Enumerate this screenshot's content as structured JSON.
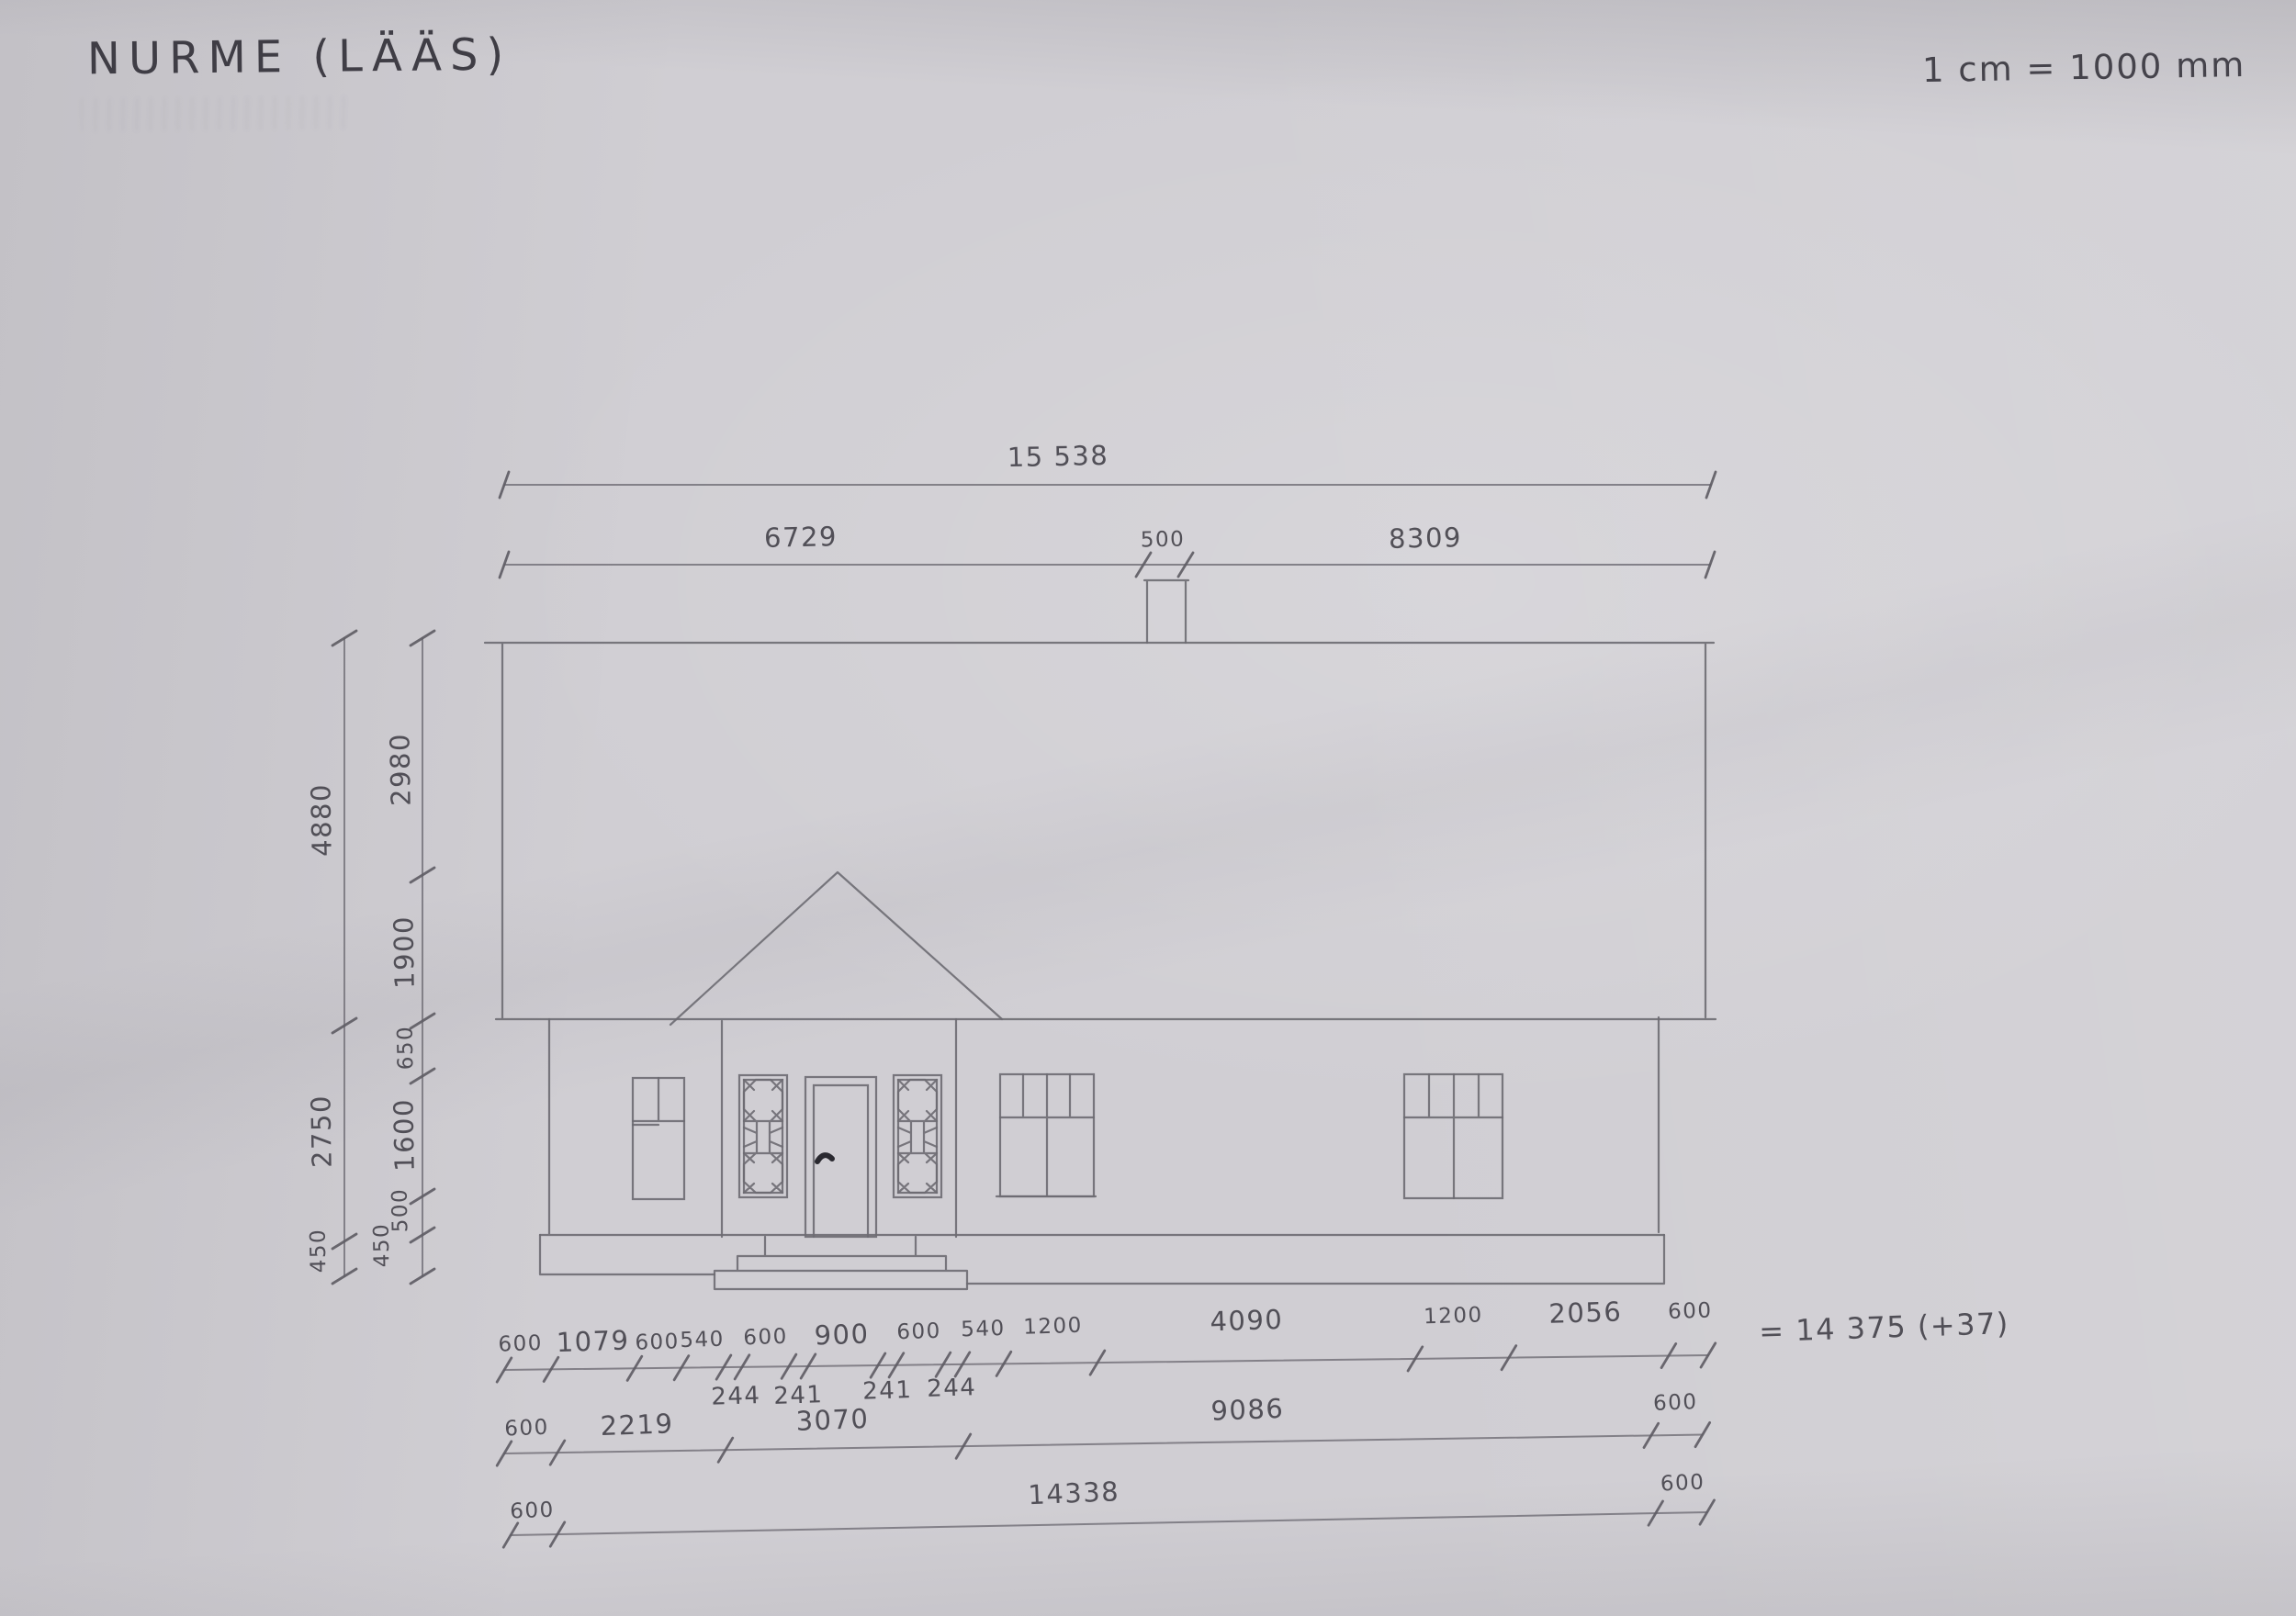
{
  "title": "NURME (LÄÄS)",
  "scale_note": "1 cm = 1000 mm",
  "colors": {
    "paper": "#d0ced3",
    "pencil": "#6d6b72",
    "handwriting": "#4b4951"
  },
  "dimensions": {
    "top_total": "15 538",
    "eave_row": [
      "6729",
      "500",
      "8309"
    ],
    "left_outer": [
      "4880",
      "2750",
      "450"
    ],
    "left_inner": [
      "2980",
      "1900",
      "650",
      "1600",
      "500",
      "450"
    ],
    "row1": {
      "segments": [
        "600",
        "1079",
        "600",
        "540",
        "600",
        "900",
        "600",
        "540",
        "1200",
        "4090",
        "1200",
        "2056",
        "600"
      ],
      "insets": [
        "244",
        "241",
        "241",
        "244"
      ],
      "sum_note": "= 14 375 (+37)"
    },
    "row2": [
      "600",
      "2219",
      "3070",
      "9086",
      "600"
    ],
    "row3": [
      "600",
      "14338",
      "600"
    ]
  }
}
